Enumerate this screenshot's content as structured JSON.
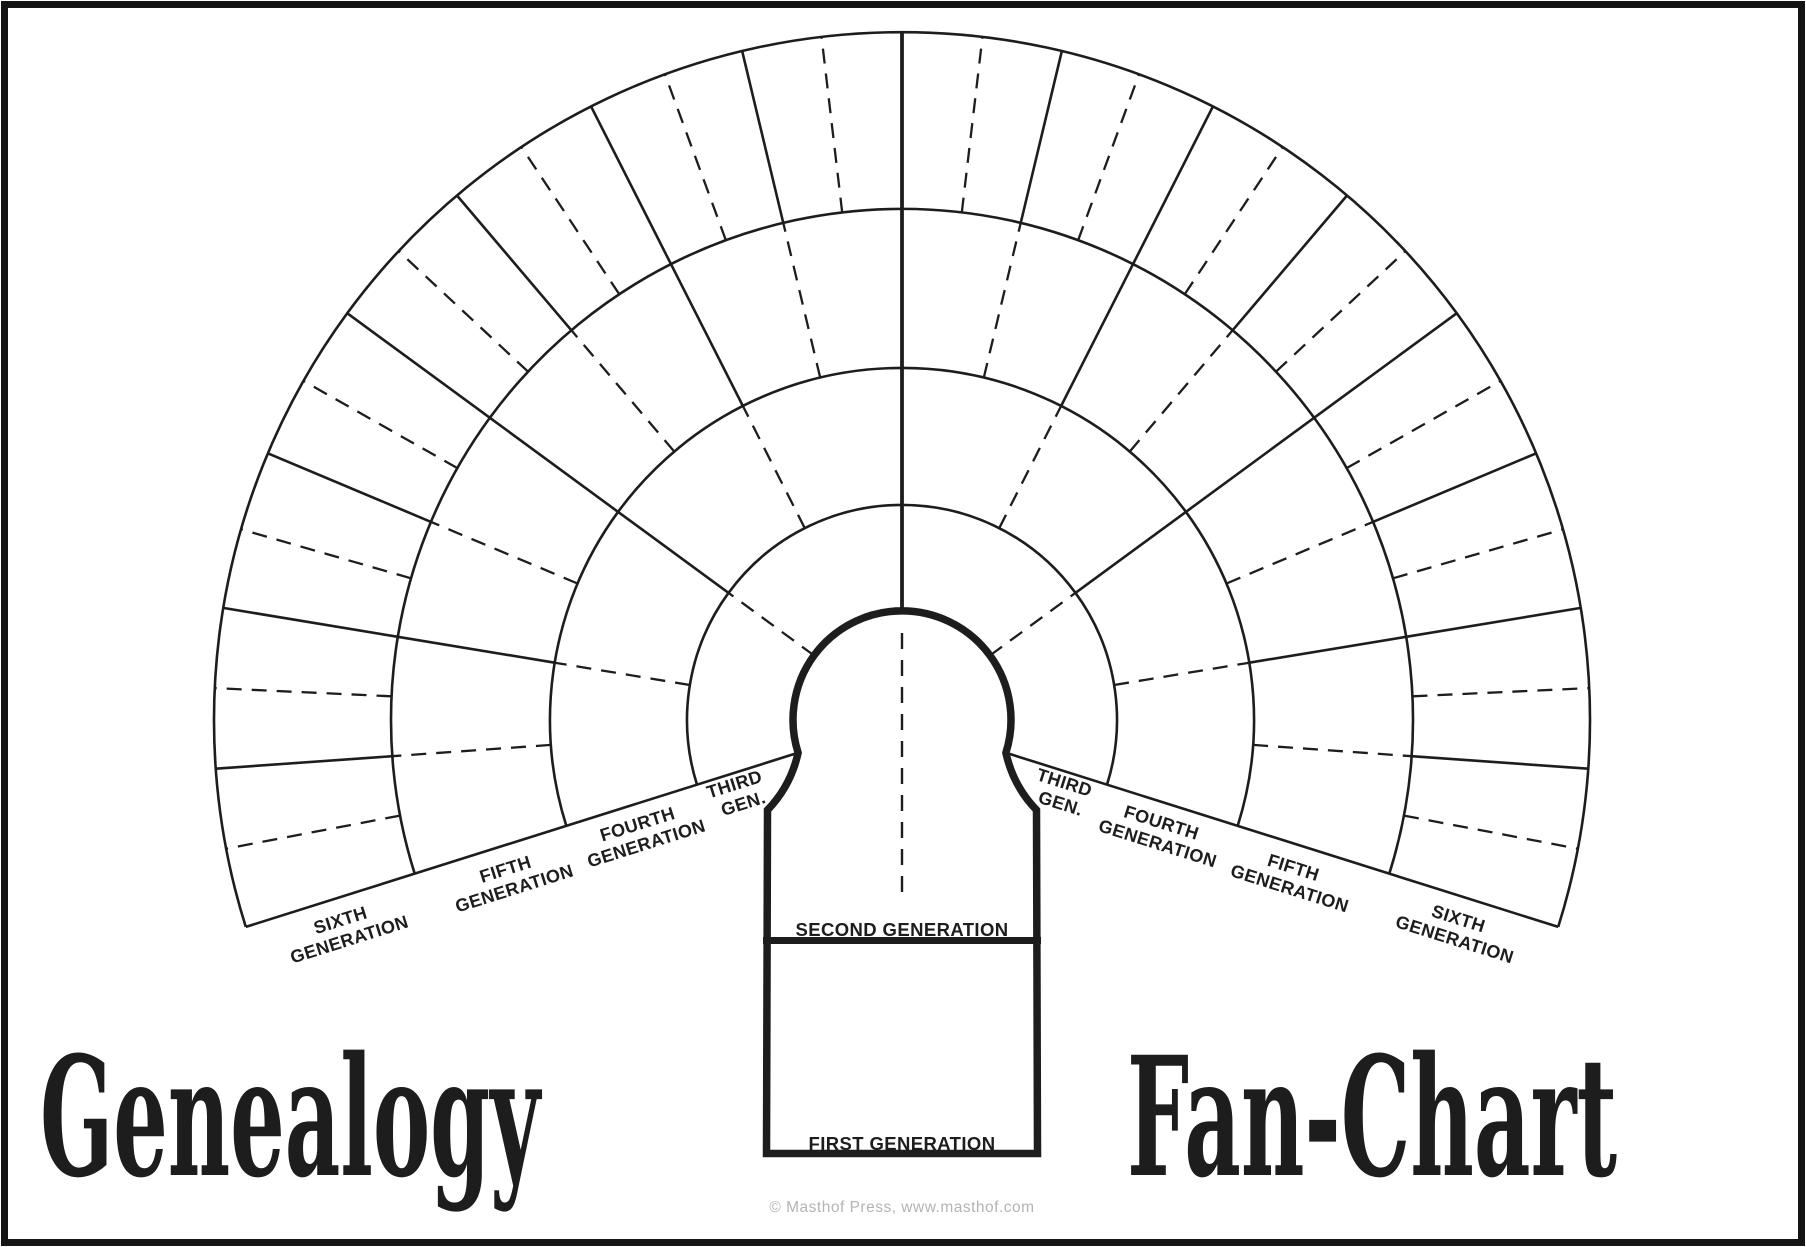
{
  "colors": {
    "ink": "#1d1d1d",
    "muted_gray": "#b4b4b4",
    "paper": "#ffffff",
    "frame_border": "#141414"
  },
  "titles": {
    "left": "Genealogy",
    "right": "Fan-Chart"
  },
  "center_panel": {
    "second_generation_label": "SECOND GENERATION",
    "first_generation_label": "FIRST GENERATION"
  },
  "ring_labels": {
    "left": [
      {
        "line1": "THIRD",
        "line2": "GEN."
      },
      {
        "line1": "FOURTH",
        "line2": "GENERATION"
      },
      {
        "line1": "FIFTH",
        "line2": "GENERATION"
      },
      {
        "line1": "SIXTH",
        "line2": "GENERATION"
      }
    ],
    "right": [
      {
        "line1": "THIRD",
        "line2": "GEN."
      },
      {
        "line1": "FOURTH",
        "line2": "GENERATION"
      },
      {
        "line1": "FIFTH",
        "line2": "GENERATION"
      },
      {
        "line1": "SIXTH",
        "line2": "GENERATION"
      }
    ]
  },
  "footer": {
    "copyright": "© Masthof Press, www.masthof.com"
  }
}
